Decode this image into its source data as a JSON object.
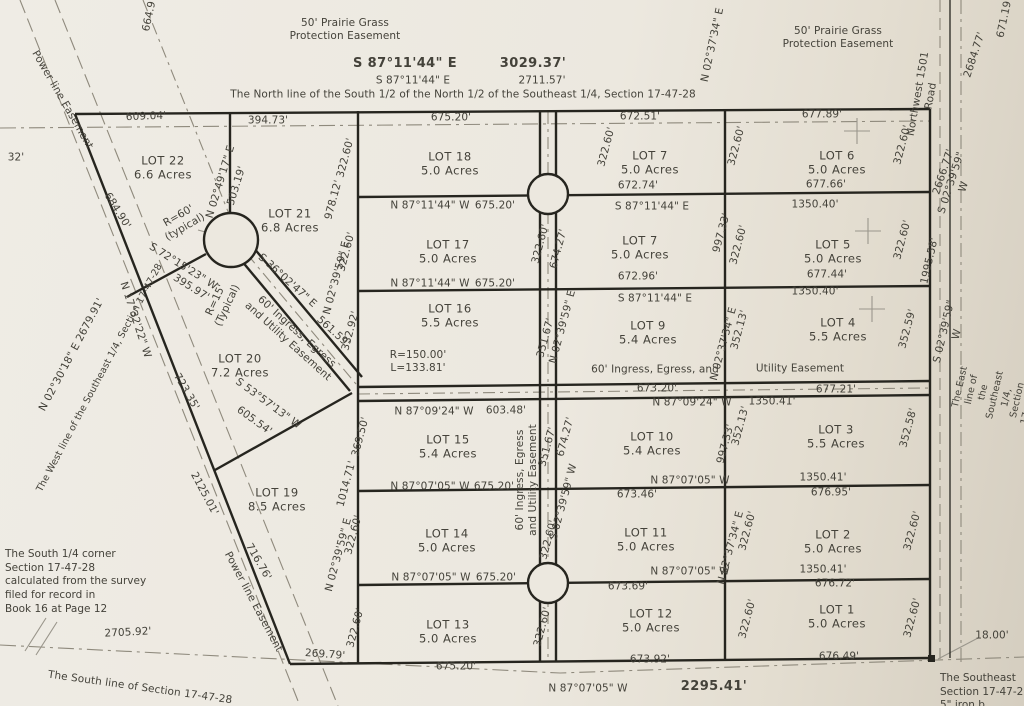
{
  "north": {
    "desc": "The North line of the South 1/2 of the North 1/2 of the Southeast 1/4, Section 17-47-28",
    "bearing_major": "S 87°11'44\" E",
    "dist_major": "3029.37'",
    "bearing_minor": "S 87°11'44\" E",
    "dist_minor": "2711.57'"
  },
  "easements": {
    "prairie": "50' Prairie Grass\nProtection Easement",
    "power_line": "Power line Easement",
    "ingress_diag": "60' Ingress, Egress\nand Utility Easement",
    "ingress_vert": "60' Ingress, Egress\nand Utility Easement",
    "ingress_h1": "60' Ingress, Egress, and",
    "ingress_h2": "Utility Easement"
  },
  "roads": {
    "nw1501": "Northwest 1501 Road"
  },
  "lines": {
    "west": "The West line of the Southeast 1/4, Section 17-47-28",
    "west_bearing": "N 02°30'18\" E   2679.91'",
    "east": "The East line of the Southeast 1/4, Section 17-47-28",
    "east_bearing": "S 02°39'59\" W",
    "east_dist": "1995.58'",
    "south": "The South line of Section 17-47-28",
    "south_dist": "2705.92'",
    "south_quarter_note": "The South 1/4 corner\nSection 17-47-28\ncalculated from the survey\nfiled for record in\nBook 16 at Page 12",
    "southeast_note": "The Southeast\nSection 17-47-2\n5\" iron b"
  },
  "lots": {
    "1": "LOT 1\n5.0 Acres",
    "2": "LOT 2\n5.0 Acres",
    "3": "LOT 3\n5.5 Acres",
    "4": "LOT 4\n5.5 Acres",
    "5": "LOT 5\n5.0 Acres",
    "6": "LOT 6\n5.0 Acres",
    "7a": "LOT 7\n5.0 Acres",
    "7b": "LOT 7\n5.0 Acres",
    "9": "LOT 9\n5.4 Acres",
    "10": "LOT 10\n5.4 Acres",
    "11": "LOT 11\n5.0 Acres",
    "12": "LOT 12\n5.0 Acres",
    "13": "LOT 13\n5.0 Acres",
    "14": "LOT 14\n5.0 Acres",
    "15": "LOT 15\n5.4 Acres",
    "16": "LOT 16\n5.5 Acres",
    "17": "LOT 17\n5.0 Acres",
    "18": "LOT 18\n5.0 Acres",
    "19": "LOT 19\n8.5 Acres",
    "20": "LOT 20\n7.2 Acres",
    "21": "LOT 21\n6.8 Acres",
    "22": "LOT 22\n6.6 Acres"
  },
  "bearings": {
    "s87_11_44_e": "S 87°11'44\" E",
    "n87_11_44_w": "N 87°11'44\" W",
    "n87_09_24_w": "N 87°09'24\" W",
    "n87_07_05_w": "N 87°07'05\" W",
    "n02_49_17_e": "N 02°49'17\" E",
    "n02_39_59_e": "N 02°39'59\" E",
    "s02_39_59_w": "S 02°39'59\" W",
    "n02_37_34_e": "N 02°37'34\" E",
    "s72_15_23_w": "S 72°15'23\" W",
    "n17_32_22_w": "N 17°32'22\" W",
    "s36_02_47_e": "S 36°02'47\" E",
    "s53_57_13_w": "S 53°57'13\" W"
  },
  "dims": {
    "d609": "609.04'",
    "d394": "394.73'",
    "d675": "675.20'",
    "d672_51": "672.51'",
    "d677_89": "677.89'",
    "d664": "664.9'",
    "d671": "671.19'",
    "d2684": "2684.77'",
    "d2666": "2666.77'",
    "d322": "322.60'",
    "d503": "503.19'",
    "d978": "978.12'",
    "d672_74": "672.74'",
    "d677_66": "677.66'",
    "d1350_40": "1350.40'",
    "d997": "997.33'",
    "d672_96": "672.96'",
    "d677_44": "677.44'",
    "d1995": "1995.58'",
    "d332": "332.92'",
    "d351": "351.67'",
    "d674": "674.27'",
    "d352_13": "352.13'",
    "d352_59": "352.59'",
    "d352_58": "352.58'",
    "d673_20": "673.20'",
    "d677_21": "677.21'",
    "r150": "R=150.00'\nL=133.81'",
    "d603": "603.48'",
    "d1350_41": "1350.41'",
    "d369": "369.50'",
    "d1014": "1014.71'",
    "d673_46": "673.46'",
    "d676_95": "676.95'",
    "d2125": "2125.01'",
    "d716": "716.76'",
    "d723": "723.35'",
    "d684": "684.90'",
    "d395": "395.97'",
    "d561": "561.59'",
    "d605": "605.54'",
    "d673_69": "673.69'",
    "d676_72": "676.72'",
    "d673_92": "673.92'",
    "d676_49": "676.49'",
    "d2295": "2295.41'",
    "d18": "18.00'",
    "d269": "269.79'",
    "d32": "32'",
    "r60": "R=60'\n(typical)",
    "r15": "R=15'\n(Typical)"
  }
}
